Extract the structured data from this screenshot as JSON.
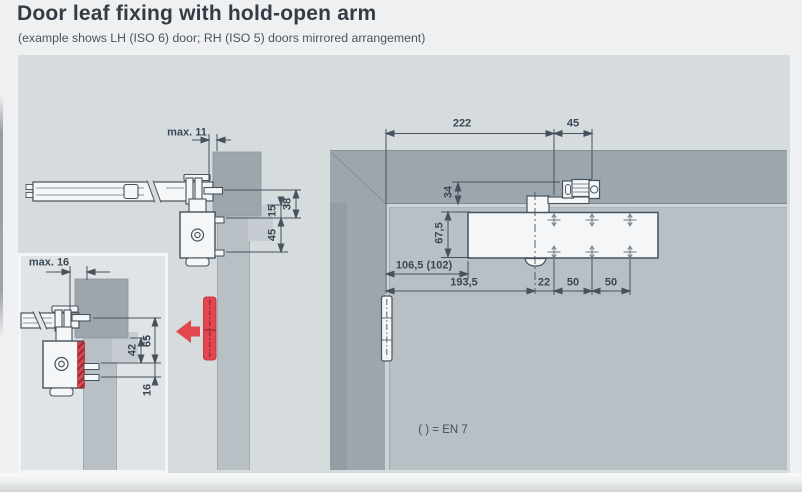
{
  "page": {
    "title": "Door leaf fixing with hold-open arm",
    "subtitle": "(example shows LH (ISO 6) door; RH (ISO 5) doors mirrored arrangement)",
    "legend_note": "( ) = EN 7"
  },
  "colors": {
    "accent_red": "#e2474f",
    "line_ink": "#46525e",
    "frame_gray": "#9da6ad",
    "door_gray": "#b9c0c5",
    "wall_gray": "#d6dbde"
  },
  "section_view": {
    "description": "door closer with slide channel, section through frame head",
    "dims": {
      "channel_to_frame_gap": "max. 11",
      "axis_to_fixing": "38",
      "frame_to_fixing": "15",
      "fixing_spacing": "45"
    }
  },
  "detail_view": {
    "description": "hold-open arm detail section",
    "dims": {
      "channel_to_frame_gap": "max. 16",
      "axis_to_fixing": "65",
      "frame_to_fixing": "42",
      "fixing_spacing": "16"
    }
  },
  "elevation_view": {
    "description": "door leaf elevation with fixing dimensions",
    "dims": {
      "hinge_to_bracket": "222",
      "bracket_fixing": "45",
      "frame_overlap": "34",
      "top_to_body": "67,5",
      "hinge_to_plate": "106,5 (102)",
      "hinge_to_spindle": "193,5",
      "spindle_to_hole": "22",
      "hole_spacing_a": "50",
      "hole_spacing_b": "50"
    }
  }
}
